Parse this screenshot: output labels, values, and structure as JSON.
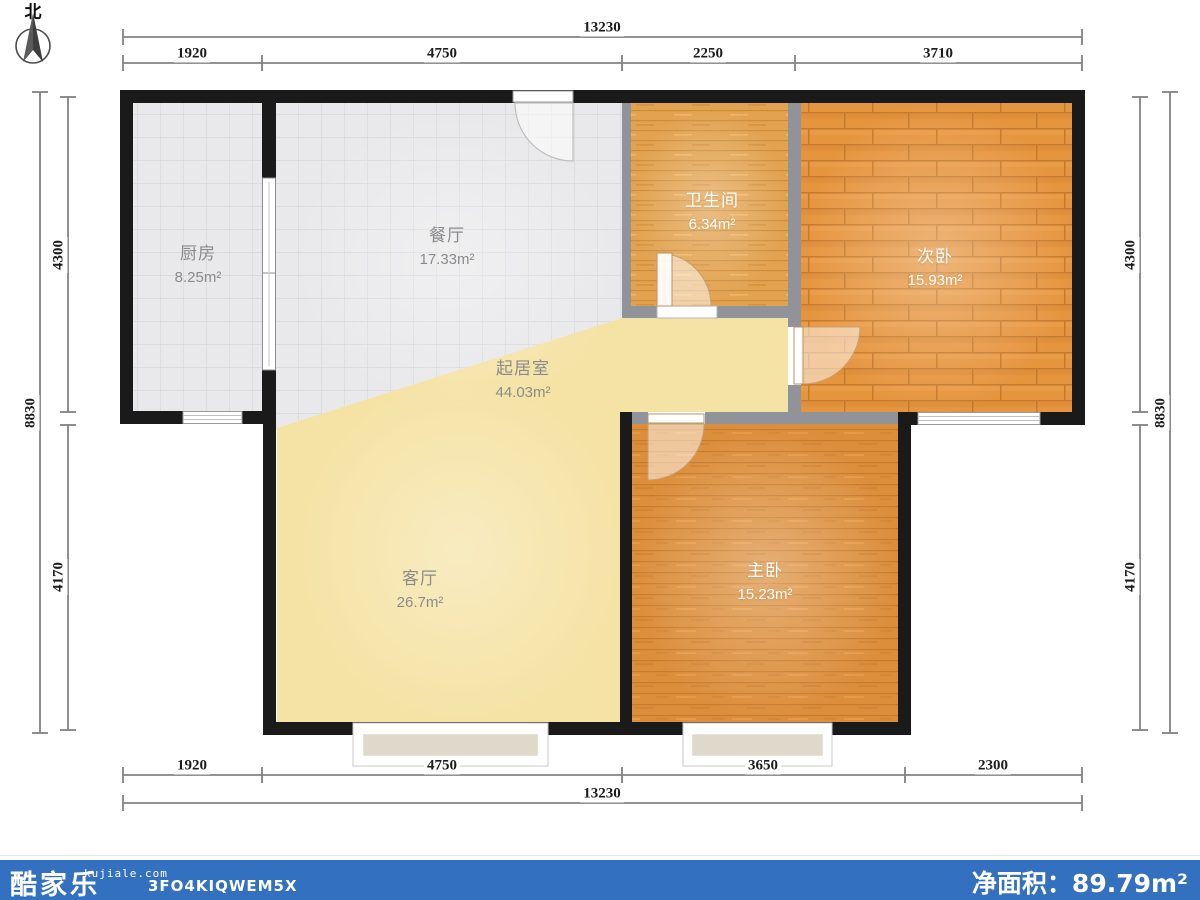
{
  "north": {
    "label": "北"
  },
  "rooms": [
    {
      "id": "kitchen",
      "name": "厨房",
      "area": "8.25m²"
    },
    {
      "id": "dining",
      "name": "餐厅",
      "area": "17.33m²"
    },
    {
      "id": "bathroom",
      "name": "卫生间",
      "area": "6.34m²"
    },
    {
      "id": "bedroom2",
      "name": "次卧",
      "area": "15.93m²"
    },
    {
      "id": "living-area",
      "name": "起居室",
      "area": "44.03m²"
    },
    {
      "id": "living-room",
      "name": "客厅",
      "area": "26.7m²"
    },
    {
      "id": "master-bedroom",
      "name": "主卧",
      "area": "15.23m²"
    }
  ],
  "dimensions": {
    "top_total": "13230",
    "top_segments": [
      "1920",
      "4750",
      "2250",
      "3710"
    ],
    "bottom_segments": [
      "1920",
      "4750",
      "3650",
      "2300"
    ],
    "bottom_total": "13230",
    "left_outer": "8830",
    "left_segments": [
      "4300",
      "4170"
    ],
    "right_outer": "8830",
    "right_segments": [
      "4300",
      "4170"
    ]
  },
  "footer": {
    "brand": "酷家乐",
    "site": "kujiale.com",
    "code": "3FO4KIQWEM5X",
    "net_area": "净面积：89.79m²"
  },
  "colors": {
    "footer_bg": "#3470c0",
    "exterior_wall": "#1a1a1a",
    "interior_wall": "#90939a",
    "tile_floor": "#e9e9eb",
    "wood_floor": "#e6953f",
    "brick_floor": "#dc8e3b",
    "bath_floor": "#e2a24f",
    "living_floor": "#f5e3a6"
  }
}
